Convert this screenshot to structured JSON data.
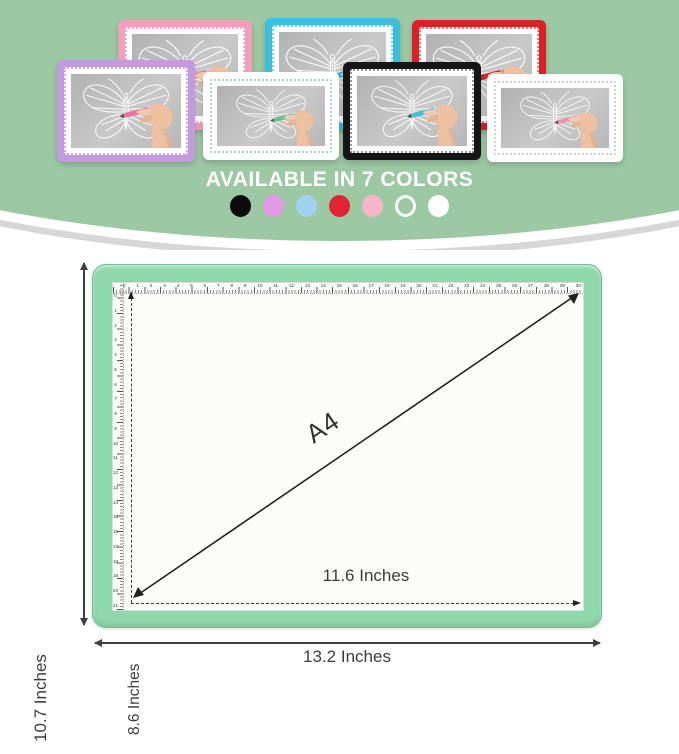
{
  "hero": {
    "title": "AVAILABLE IN 7 COLORS",
    "background_color": "#9cc8a3",
    "swatches": [
      {
        "name": "black",
        "color": "#0b0b0b",
        "style": "solid"
      },
      {
        "name": "violet",
        "color": "#e09ae6",
        "style": "solid"
      },
      {
        "name": "light-blue",
        "color": "#9fd2ef",
        "style": "solid"
      },
      {
        "name": "red",
        "color": "#e12336",
        "style": "solid"
      },
      {
        "name": "pink",
        "color": "#f8b4c9",
        "style": "solid"
      },
      {
        "name": "white-outline",
        "color": "#ffffff",
        "style": "outline"
      },
      {
        "name": "white",
        "color": "#ffffff",
        "style": "solid"
      }
    ],
    "pads": [
      {
        "name": "pink",
        "frame": "#f29fbc",
        "dots": "#f4afc8",
        "pen": "#e8709a"
      },
      {
        "name": "cyan",
        "frame": "#3bbfde",
        "dots": "#7dd3e8",
        "pen": "#35b9d6"
      },
      {
        "name": "red",
        "frame": "#d92125",
        "dots": "#e37b7d",
        "pen": "#d2272c"
      },
      {
        "name": "purple",
        "frame": "#c49ade",
        "dots": "#cfaae3",
        "pen": "#ef6f9e"
      },
      {
        "name": "white-mint",
        "frame": "#ffffff",
        "dots": "#a8d9bd",
        "pen": "#63c08a"
      },
      {
        "name": "black",
        "frame": "#161616",
        "dots": "#9a9a9a",
        "pen": "#46c0d8"
      },
      {
        "name": "white",
        "frame": "#fdfdfd",
        "dots": "#d0d0d0",
        "pen": "#ef8fb0"
      }
    ]
  },
  "diagram": {
    "pad_color": "#8fd8ac",
    "pad_border_color": "#6cc28f",
    "line_color": "#3f3f3f",
    "labels": {
      "outer_height": "10.7 Inches",
      "inner_height": "8.6 Inches",
      "diagonal": "A4",
      "inner_width": "11.6 Inches",
      "outer_width": "13.2 Inches"
    },
    "ruler": {
      "top_numbers": [
        0,
        1,
        2,
        3,
        4,
        5,
        6,
        7,
        8,
        9,
        10,
        11,
        12,
        13,
        14,
        15,
        16,
        17,
        18,
        19,
        20,
        21,
        22,
        23,
        24,
        25,
        26,
        27,
        28,
        29,
        30
      ],
      "left_numbers": [
        0,
        1,
        2,
        3,
        4,
        5,
        6,
        7,
        8,
        9,
        10,
        11,
        12,
        13,
        14,
        15,
        16,
        17,
        18,
        19,
        20,
        21
      ]
    }
  }
}
